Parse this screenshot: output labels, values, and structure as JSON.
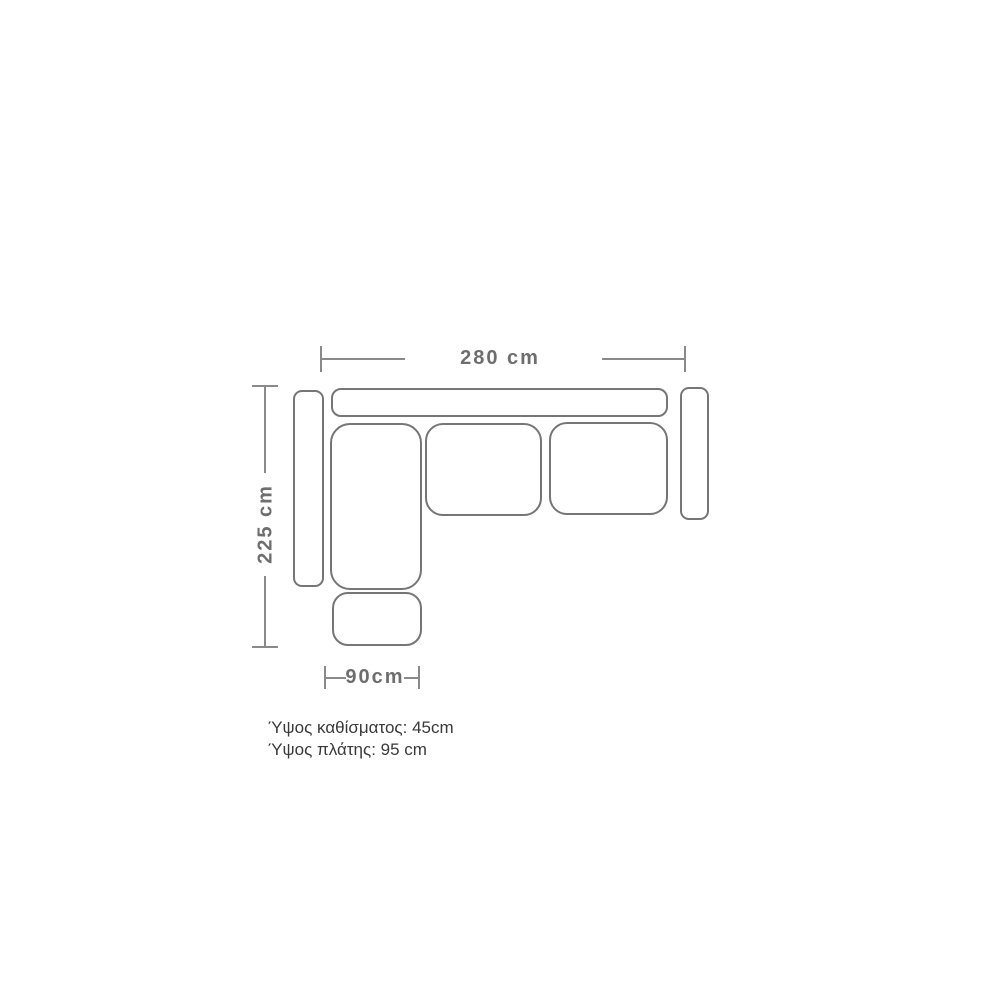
{
  "diagram": {
    "type": "sofa-floorplan-dimension-diagram",
    "dimension_width": {
      "label": "280 cm"
    },
    "dimension_depth": {
      "label": "225 cm"
    },
    "dimension_chaise": {
      "label": "90cm"
    },
    "notes": {
      "seat_height": "Ύψος καθίσματος: 45cm",
      "back_height": "Ύψος πλάτης: 95 cm"
    },
    "parts": [
      "left-armrest",
      "backrest",
      "right-armrest",
      "chaise-seat",
      "middle-seat-cushion",
      "right-seat-cushion",
      "ottoman"
    ],
    "colors": {
      "background": "#ffffff",
      "outline": "#767676",
      "dimension_line": "#8a8a8a",
      "dimension_text": "#6e6e6e",
      "note_text": "#3a3a3a"
    }
  }
}
